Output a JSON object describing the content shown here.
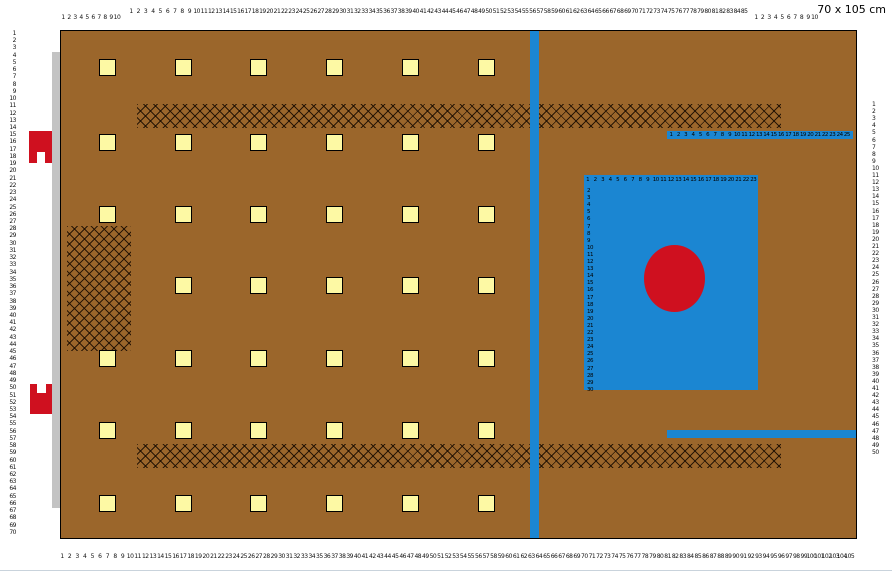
{
  "header": {
    "size_label": "70 x 105 cm"
  },
  "colors": {
    "fabric_brown": "#9b662b",
    "accent_blue": "#1b86d2",
    "accent_red": "#cf101f",
    "square_yellow": "#fdf9a4",
    "strip_gray": "#c3c3c3",
    "border_black": "#000000"
  },
  "rulers": [
    {
      "id": "top-left-small",
      "orient": "h",
      "from": 1,
      "to": 10,
      "x": 63,
      "y": 15,
      "step": 6.0
    },
    {
      "id": "top-main",
      "orient": "h",
      "from": 1,
      "to": 85,
      "x": 131,
      "y": 9,
      "step": 7.3
    },
    {
      "id": "top-right-small",
      "orient": "h",
      "from": 1,
      "to": 10,
      "x": 756,
      "y": 15,
      "step": 6.5
    },
    {
      "id": "bottom-main",
      "orient": "h",
      "from": 1,
      "to": 105,
      "x": 62,
      "y": 554,
      "step": 7.57
    },
    {
      "id": "left-main",
      "orient": "v",
      "from": 1,
      "to": 70,
      "x": 16,
      "y": 31,
      "step": 7.23,
      "align": "right"
    },
    {
      "id": "right-main",
      "orient": "v",
      "from": 1,
      "to": 50,
      "x": 872,
      "y": 102,
      "step": 7.1,
      "align": "left"
    }
  ],
  "canvas": {
    "x": 60,
    "y": 30,
    "w": 795,
    "h": 507
  },
  "gray_strip": {
    "x": 52,
    "y": 52,
    "w": 8,
    "h": 456
  },
  "hatch_patches": [
    {
      "id": "hatch-band-top",
      "x": 76,
      "y": 73,
      "w": 644,
      "h": 24
    },
    {
      "id": "hatch-band-bottom",
      "x": 76,
      "y": 413,
      "w": 644,
      "h": 24
    },
    {
      "id": "hatch-patch-left",
      "x": 6,
      "y": 195,
      "w": 64,
      "h": 125
    }
  ],
  "blue_stripe": {
    "x": 469,
    "y": 0,
    "w": 9,
    "h": 507
  },
  "squares": {
    "cols_x": [
      38,
      114,
      189,
      265,
      341,
      417
    ],
    "rows_y": [
      28,
      103,
      175,
      246,
      319,
      391,
      464
    ],
    "size": 15,
    "skip": [
      {
        "row": 3,
        "col": 0
      }
    ]
  },
  "blue_panel": {
    "x": 523,
    "y": 144,
    "w": 174,
    "h": 215,
    "top_ruler": {
      "from": 1,
      "to": 23,
      "x": 3,
      "y": 2,
      "step": 7.5
    },
    "left_ruler": {
      "from": 2,
      "to": 30,
      "x": 3,
      "y": 13,
      "step": 7.1
    },
    "circle": {
      "x": 60,
      "y": 70,
      "w": 61,
      "h": 67
    }
  },
  "blue_bars": [
    {
      "id": "blue-ruler-bar",
      "x": 606,
      "y": 100,
      "w": 186,
      "h": 8,
      "ruler": {
        "from": 1,
        "to": 25,
        "x": 4,
        "y": 1,
        "step": 7.33
      }
    },
    {
      "id": "blue-plain-bar",
      "x": 606,
      "y": 399,
      "w": 189,
      "h": 8
    }
  ],
  "red_clips": [
    {
      "id": "red-clip-top",
      "x": 29,
      "y": 131,
      "w": 23,
      "h": 32,
      "notch": {
        "x": 8,
        "y": 21,
        "w": 8,
        "h": 11
      }
    },
    {
      "id": "red-clip-bottom",
      "x": 30,
      "y": 384,
      "w": 22,
      "h": 30,
      "notch": {
        "x": 7,
        "y": 0,
        "w": 9,
        "h": 9
      }
    }
  ]
}
